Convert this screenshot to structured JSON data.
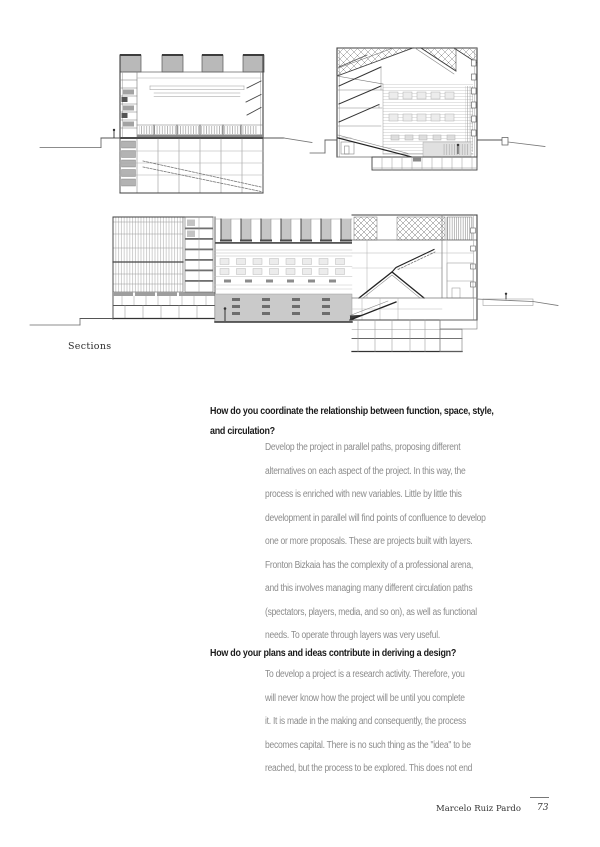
{
  "figure": {
    "caption": "Sections"
  },
  "interview": {
    "qa1": {
      "question_lines": [
        "How do you coordinate the relationship between function, space, style,",
        "and circulation?"
      ],
      "answer_lines": [
        "Develop the project in parallel paths, proposing different",
        "alternatives on each aspect of the project. In this way, the",
        "process is enriched with new variables. Little by little this",
        "development in parallel will find points of confluence to develop",
        "one or more proposals. These are projects built with layers.",
        "Fronton Bizkaia has the complexity of a professional arena,",
        "and this involves managing many different circulation paths",
        "(spectators, players, media, and so on), as well as functional",
        "needs. To operate through layers was very useful."
      ]
    },
    "qa2": {
      "question_lines": [
        "How do your plans and ideas contribute in deriving a design?"
      ],
      "answer_lines": [
        "To develop a project is a research activity. Therefore, you",
        "will never know how the project will be until you complete",
        "it. It is made in the making and consequently, the process",
        "becomes capital. There is no such thing as the \"idea\" to be",
        "reached, but the process to be explored. This does not end"
      ]
    }
  },
  "footer": {
    "author": "Marcelo Ruiz Pardo",
    "page_number": "73"
  }
}
